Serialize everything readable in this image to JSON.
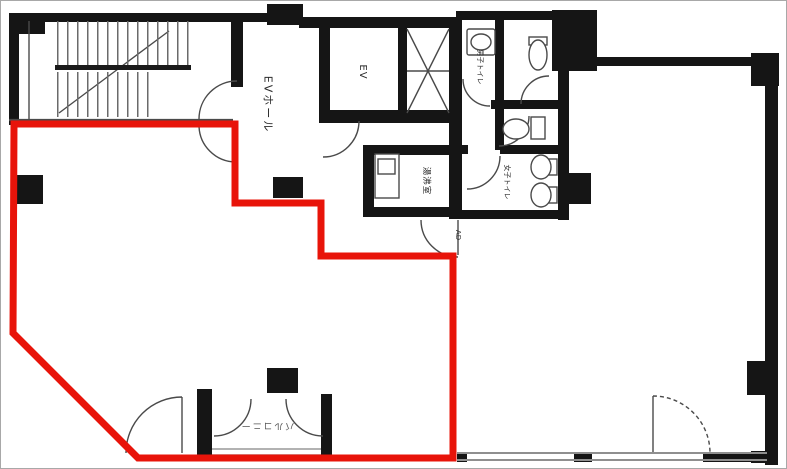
{
  "labels": {
    "ev_hall": "EVホール",
    "elevator": "EV",
    "kitchenette": "湯沸室",
    "mens_toilet": "男子トイレ",
    "womens_toilet": "女子トイレ",
    "duct": "AD",
    "balcony": "バルコニー"
  },
  "colors": {
    "tenant_outline": "#e8140a",
    "wall": "#151515",
    "line": "#4a4a4a"
  }
}
